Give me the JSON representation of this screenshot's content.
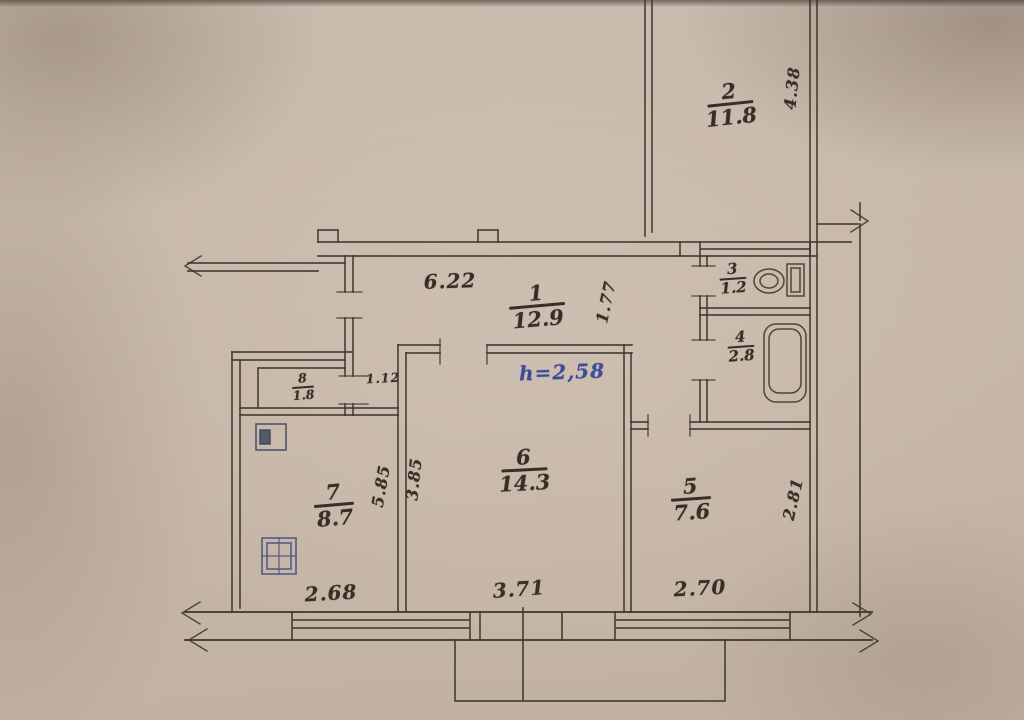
{
  "rooms": {
    "room2": {
      "number": "2",
      "area": "11.8"
    },
    "corridor": {
      "number": "1",
      "area": "12.9"
    },
    "toilet": {
      "number": "3",
      "area": "1.2"
    },
    "bath": {
      "number": "4",
      "area": "2.8"
    },
    "kitchen": {
      "number": "5",
      "area": "7.6"
    },
    "living": {
      "number": "6",
      "area": "14.3"
    },
    "bedroom": {
      "number": "7",
      "area": "8.7"
    },
    "closet": {
      "number": "8",
      "area": "1.8"
    }
  },
  "annotations": {
    "ceiling_height": "h=2,58"
  },
  "dimensions": {
    "corridor_width": "6.22",
    "corridor_depth": "1.77",
    "room2_depth": "4.38",
    "closet_door_width": "1.12",
    "bedroom_side": "5.85",
    "living_depth": "3.85",
    "bedroom_width": "2.68",
    "living_width": "3.71",
    "kitchen_width": "2.70",
    "kitchen_depth": "2.81"
  },
  "icons": [
    "toilet-icon",
    "bathtub-icon",
    "vent-icon",
    "stove-icon"
  ],
  "colors": {
    "paper": "#c7b9ab",
    "ink": "#3a342c",
    "blue_ink": "#3c4b9a"
  }
}
